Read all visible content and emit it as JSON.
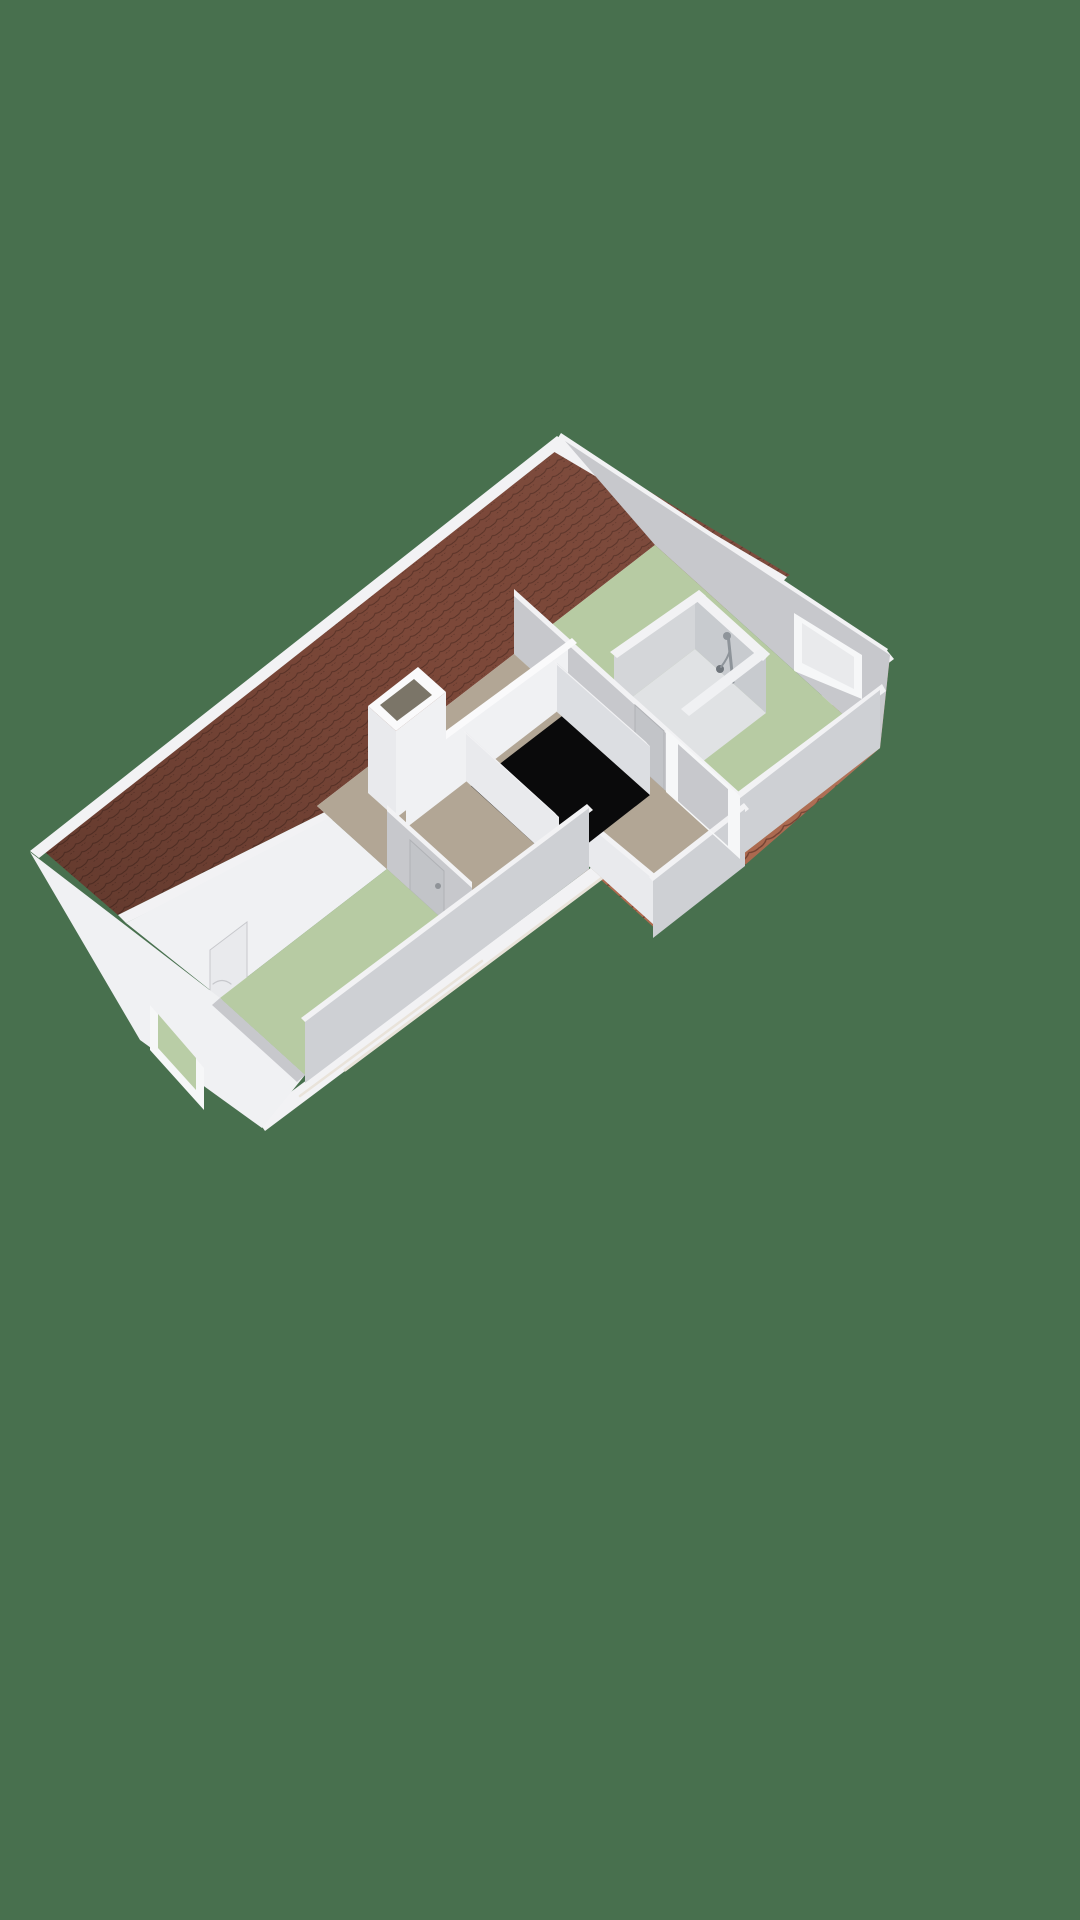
{
  "description": "3D isometric floor plan render of an attic storey with hipped red tile roof, two green-floored bedrooms, central taupe landing, stairwell opening, chimney shaft and shower room",
  "palette": {
    "background": "#48704E",
    "roof_dark_base": "#7c4839",
    "roof_dark_line": "#5a3328",
    "roof_light_base": "#b16a4e",
    "roof_light_line": "#74402f",
    "fascia": "#f2f2f4",
    "wall_white": "#f0f1f3",
    "wall_bright": "#fafafb",
    "wall_light": "#e9eaed",
    "wall_mid": "#dcdee2",
    "wall_gray": "#c7c8cc",
    "wall_gray_dark": "#ced0d4",
    "wall_shadow_light": "#d4d6d9",
    "wall_gray2": "#c8cbcf",
    "floor_green": "#b7cba3",
    "floor_taupe": "#b2a695",
    "shower_tray": "#e0e2e4",
    "stair_black": "#0a0a0b",
    "chimney_dark": "#7b7568",
    "window_frame": "#f6f7f8",
    "glass_pale": "#e9eaec",
    "glass_green": "#b9cda6",
    "door_gray": "#c2c4c8",
    "door_edge": "#b0b2b6",
    "handle": "#8f9398",
    "fixture": "#8e949a",
    "fixture_dark": "#70767c",
    "seam": "#e9e3da",
    "shade_dark": "rgba(0,0,0,0.20)",
    "shade_light": "rgba(255,255,255,0.16)"
  },
  "rooms": [
    {
      "id": "bedroom-southwest",
      "floor_color_key": "floor_green"
    },
    {
      "id": "landing",
      "floor_color_key": "floor_taupe"
    },
    {
      "id": "bedroom-northeast",
      "floor_color_key": "floor_green"
    },
    {
      "id": "shower-room",
      "floor_color_key": "shower_tray"
    }
  ],
  "scene": {
    "width": 1080,
    "height": 1920,
    "elements": [
      {
        "name": "backdrop",
        "type": "poly",
        "pts": "0,0 1080,0 1080,1920 0,1920",
        "fill": "background"
      },
      {
        "name": "roof-plane-northwest-tiles",
        "type": "poly",
        "pts": "38,846 563,440 790,575 700,625 118,915",
        "fill": "url(#tilesL)"
      },
      {
        "name": "roof-plane-northwest-shading",
        "type": "poly",
        "pts": "38,846 563,440 790,575 700,625 118,915",
        "fill": "url(#gradL)"
      },
      {
        "name": "roof-northwest-fascia-band",
        "type": "poly",
        "pts": "30,851 557,436 566,443 39,858",
        "fill": "fascia"
      },
      {
        "name": "roof-northwest-hip-band",
        "type": "poly",
        "pts": "558,442 787,577 780,585 551,450",
        "fill": "fascia"
      },
      {
        "name": "roof-northwest-cut-band",
        "type": "poly",
        "pts": "118,915 700,625 708,633 126,923",
        "fill": "fascia"
      },
      {
        "name": "knee-wall-northwest",
        "type": "poly",
        "pts": "126,923 700,625 655,545 514,654 317,806 387,869 220,998",
        "fill": "wall_white"
      },
      {
        "name": "eaves-storage-door",
        "type": "poly",
        "pts": "210,950 247,922 247,980 210,1008",
        "fill": "wall_light",
        "stroke": "wall_gray",
        "w": 1
      },
      {
        "name": "eaves-storage-door-mark",
        "type": "path",
        "d": "M213,984 q9,-7 18,0",
        "stroke": "wall_gray",
        "w": 1.2,
        "fill": "none"
      },
      {
        "name": "roof-plane-southeast-tiles",
        "type": "poly",
        "pts": "262,1125 890,655 880,748 745,865 659,932 589,869 311,1083",
        "fill": "url(#tilesR)"
      },
      {
        "name": "roof-plane-southeast-shading",
        "type": "poly",
        "pts": "262,1125 890,655 880,748 745,865 659,932 589,869 311,1083",
        "fill": "url(#gradR)"
      },
      {
        "name": "roof-southeast-fascia-band",
        "type": "poly",
        "pts": "256,1118 885,648 894,659 265,1131",
        "fill": "fascia"
      },
      {
        "name": "roof-southeast-seam-line-1",
        "type": "line",
        "x1": 345,
        "y1": 1070,
        "x2": 610,
        "y2": 872,
        "stroke": "seam",
        "w": 3,
        "fill": "none"
      },
      {
        "name": "roof-southeast-seam-line-2",
        "type": "line",
        "x1": 300,
        "y1": 1096,
        "x2": 482,
        "y2": 961,
        "stroke": "seam",
        "w": 2.5,
        "fill": "none"
      },
      {
        "name": "gable-northeast-top-band",
        "type": "poly",
        "pts": "561,433 888,649 883,657 556,441",
        "fill": "fascia"
      },
      {
        "name": "gable-northeast-wall",
        "type": "poly",
        "pts": "565,441 890,655 880,748 655,545",
        "fill": "wall_gray"
      },
      {
        "name": "gable-northeast-window-frame",
        "type": "poly",
        "pts": "794,613 862,655 862,699 794,671",
        "fill": "window_frame"
      },
      {
        "name": "gable-northeast-window-glass",
        "type": "poly",
        "pts": "802,623 854,657 854,689 802,663",
        "fill": "glass_pale"
      },
      {
        "name": "bedroom-northeast-floor",
        "type": "poly",
        "pts": "514,654 655,545 880,748 739,857",
        "fill": "floor_green"
      },
      {
        "name": "shower-tray-floor",
        "type": "poly",
        "pts": "614,711 695,649 766,713 685,775",
        "fill": "shower_tray"
      },
      {
        "name": "shower-wall-inner-northwest",
        "type": "poly",
        "pts": "614,656 695,594 695,649 614,711",
        "fill": "wall_shadow_light"
      },
      {
        "name": "shower-wall-inner-northeast",
        "type": "poly",
        "pts": "695,594 766,658 766,713 695,649",
        "fill": "wall_gray2"
      },
      {
        "name": "shower-riser-bar",
        "type": "line",
        "x1": 728,
        "y1": 634,
        "x2": 733,
        "y2": 682,
        "stroke": "fixture",
        "w": 3,
        "fill": "none"
      },
      {
        "name": "shower-head",
        "type": "circle",
        "cx": 727,
        "cy": 636,
        "r": 4,
        "fill": "fixture"
      },
      {
        "name": "shower-mixer-valve",
        "type": "circle",
        "cx": 720,
        "cy": 669,
        "r": 4,
        "fill": "fixture_dark"
      },
      {
        "name": "shower-hose",
        "type": "path",
        "d": "M721,667 Q728,658 730,650",
        "stroke": "fixture",
        "w": 2,
        "fill": "none"
      },
      {
        "name": "shower-wall-top-northwest",
        "type": "poly",
        "pts": "610,652 699,590 706,596 617,658",
        "fill": "fascia"
      },
      {
        "name": "shower-wall-top-northeast",
        "type": "poly",
        "pts": "699,590 770,654 763,661 692,597",
        "fill": "fascia"
      },
      {
        "name": "shower-wall-top-southeast",
        "type": "poly",
        "pts": "770,654 689,716 681,709 762,647",
        "fill": "wall_white"
      },
      {
        "name": "shower-threshold",
        "type": "poly",
        "pts": "614,700 685,764 685,776 614,712",
        "fill": "wall_white"
      },
      {
        "name": "knee-wall-southeast-bedroom-ne-top",
        "type": "poly",
        "pts": "735,794 882,684 886,691 739,801",
        "fill": "fascia"
      },
      {
        "name": "knee-wall-southeast-bedroom-ne",
        "type": "poly",
        "pts": "739,799 880,690 880,748 739,857",
        "fill": "wall_gray_dark"
      },
      {
        "name": "wall-landing-bedroom-ne-top",
        "type": "poly",
        "pts": "514,589 739,792 739,800 514,597",
        "fill": "fascia"
      },
      {
        "name": "wall-landing-bedroom-ne",
        "type": "poly",
        "pts": "514,596 739,799 739,857 514,654",
        "fill": "wall_gray"
      },
      {
        "name": "door-bedroom-northeast",
        "type": "poly",
        "pts": "635,705 664,731 664,790 635,763",
        "fill": "door_gray",
        "stroke": "door_edge",
        "w": 1
      },
      {
        "name": "door-bedroom-northeast-handle",
        "type": "circle",
        "cx": 641,
        "cy": 749,
        "r": 3,
        "fill": "handle"
      },
      {
        "name": "landing-floor",
        "type": "poly",
        "pts": "317,806 514,654 739,857 653,924 583,861 472,946",
        "fill": "floor_taupe"
      },
      {
        "name": "corridor-step-wall",
        "type": "poly",
        "pts": "583,815 653,878 653,924 583,861",
        "fill": "wall_light"
      },
      {
        "name": "corridor-step-wall-top",
        "type": "poly",
        "pts": "580,812 656,875 653,879 577,816",
        "fill": "fascia"
      },
      {
        "name": "knee-wall-southeast-corridor-top",
        "type": "poly",
        "pts": "649,877 744,803 749,809 654,883",
        "fill": "fascia"
      },
      {
        "name": "knee-wall-southeast-corridor",
        "type": "poly",
        "pts": "653,881 745,809 745,866 653,938",
        "fill": "wall_gray_dark"
      },
      {
        "name": "stairwell-opening",
        "type": "poly",
        "pts": "471,786 562,716 650,795 559,866",
        "fill": "stair_black"
      },
      {
        "name": "stairwell-wall-northwest",
        "type": "poly",
        "pts": "406,767 568,642 568,703 406,828",
        "fill": "wall_white"
      },
      {
        "name": "stairwell-wall-northwest-top",
        "type": "poly",
        "pts": "402,763 572,638 577,643 407,768",
        "fill": "wall_bright"
      },
      {
        "name": "stairwell-balustrade-southwest",
        "type": "poly",
        "pts": "466,732 559,817 559,866 466,781",
        "fill": "wall_light"
      },
      {
        "name": "stairwell-balustrade-southwest-top",
        "type": "poly",
        "pts": "461,728 555,813 559,818 465,733",
        "fill": "fascia"
      },
      {
        "name": "stairwell-balustrade-northeast",
        "type": "poly",
        "pts": "557,663 650,746 650,795 557,712",
        "fill": "wall_mid"
      },
      {
        "name": "stairwell-balustrade-northeast-top",
        "type": "poly",
        "pts": "552,659 646,742 650,747 556,664",
        "fill": "fascia"
      },
      {
        "name": "chimney-shaft-face-southwest",
        "type": "poly",
        "pts": "368,706 396,731 396,818 368,793",
        "fill": "wall_light"
      },
      {
        "name": "chimney-shaft-face-southeast",
        "type": "poly",
        "pts": "396,731 446,692 446,779 396,818",
        "fill": "wall_white"
      },
      {
        "name": "chimney-shaft-top",
        "type": "poly",
        "pts": "368,706 418,667 446,692 396,731",
        "fill": "wall_bright"
      },
      {
        "name": "chimney-shaft-opening",
        "type": "poly",
        "pts": "380,705 414,679 432,695 397,721",
        "fill": "chimney_dark"
      },
      {
        "name": "wall-landing-bedroom-sw-top",
        "type": "poly",
        "pts": "387,805 472,882 472,890 387,813",
        "fill": "fascia"
      },
      {
        "name": "wall-landing-bedroom-sw",
        "type": "poly",
        "pts": "387,811 472,888 472,946 387,869",
        "fill": "wall_gray"
      },
      {
        "name": "door-bedroom-southwest",
        "type": "poly",
        "pts": "410,840 444,871 444,921 410,890",
        "fill": "door_gray",
        "stroke": "door_edge",
        "w": 1
      },
      {
        "name": "door-bedroom-southwest-handle",
        "type": "circle",
        "cx": 438,
        "cy": 886,
        "r": 3,
        "fill": "handle"
      },
      {
        "name": "bedroom-southwest-floor",
        "type": "poly",
        "pts": "220,998 387,869 472,946 305,1075",
        "fill": "floor_green"
      },
      {
        "name": "knee-wall-southeast-bedroom-sw-top",
        "type": "poly",
        "pts": "301,1018 587,804 593,810 307,1024",
        "fill": "fascia"
      },
      {
        "name": "knee-wall-southeast-bedroom-sw",
        "type": "poly",
        "pts": "305,1022 589,808 589,869 305,1083",
        "fill": "wall_gray_dark"
      },
      {
        "name": "gable-southwest-wall",
        "type": "poly",
        "pts": "30,852 220,998 305,1075 262,1128 140,1040",
        "fill": "wall_white"
      },
      {
        "name": "gable-southwest-inner-sliver",
        "type": "poly",
        "pts": "220,998 305,1075 297,1082 212,1005",
        "fill": "wall_gray"
      },
      {
        "name": "gable-southwest-window-frame",
        "type": "poly",
        "pts": "150,1005 204,1068 204,1110 150,1050",
        "fill": "window_frame"
      },
      {
        "name": "gable-southwest-window-glass",
        "type": "poly",
        "pts": "158,1014 196,1058 196,1090 158,1048",
        "fill": "glass_green"
      },
      {
        "name": "corridor-open-door-frame",
        "type": "poly",
        "pts": "666,729 740,796 740,859 666,792",
        "holes": [
          "678,744 728,789 728,846 678,801"
        ],
        "fill": "window_frame"
      }
    ]
  }
}
